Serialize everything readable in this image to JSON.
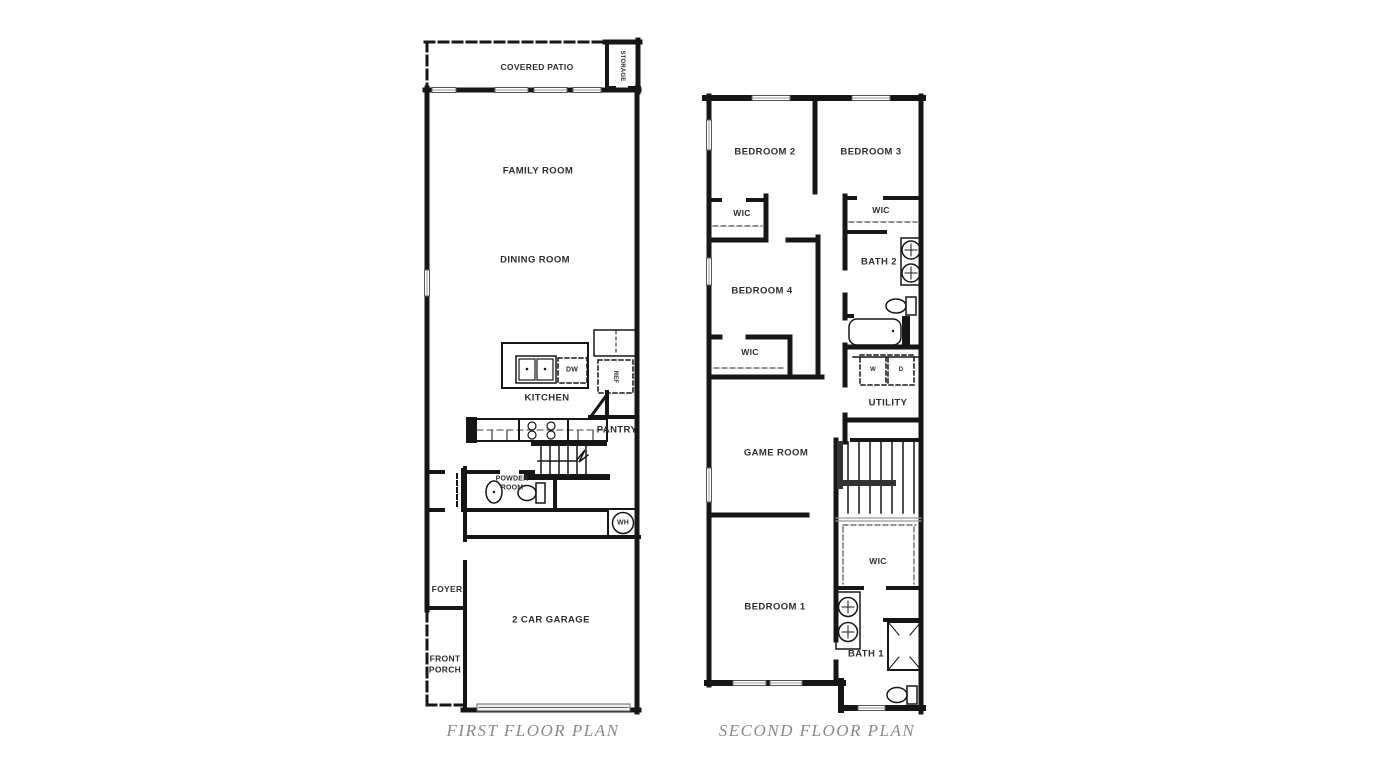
{
  "colors": {
    "wall": "#161616",
    "label": "#2e2e2e",
    "caption": "#8a8a8a",
    "background": "#ffffff"
  },
  "first_floor": {
    "caption": "FIRST FLOOR PLAN",
    "rooms": {
      "covered_patio": "COVERED PATIO",
      "storage": "STORAGE",
      "family_room": "FAMILY ROOM",
      "dining_room": "DINING ROOM",
      "kitchen": "KITCHEN",
      "pantry": "PANTRY",
      "powder_room": "POWDER ROOM",
      "foyer": "FOYER",
      "garage": "2 CAR GARAGE",
      "front_porch": "FRONT PORCH"
    },
    "fixtures": {
      "dishwasher": "DW",
      "refrigerator": "REF",
      "water_heater": "WH"
    }
  },
  "second_floor": {
    "caption": "SECOND FLOOR PLAN",
    "rooms": {
      "bedroom_2": "BEDROOM 2",
      "bedroom_3": "BEDROOM 3",
      "bedroom_4": "BEDROOM 4",
      "bedroom_1": "BEDROOM 1",
      "wic_bedroom_2": "WIC",
      "wic_bedroom_3": "WIC",
      "wic_bedroom_4": "WIC",
      "wic_bedroom_1": "WIC",
      "bath_2": "BATH 2",
      "bath_1": "BATH 1",
      "utility": "UTILITY",
      "game_room": "GAME ROOM"
    },
    "fixtures": {
      "washer": "W",
      "dryer": "D"
    }
  }
}
